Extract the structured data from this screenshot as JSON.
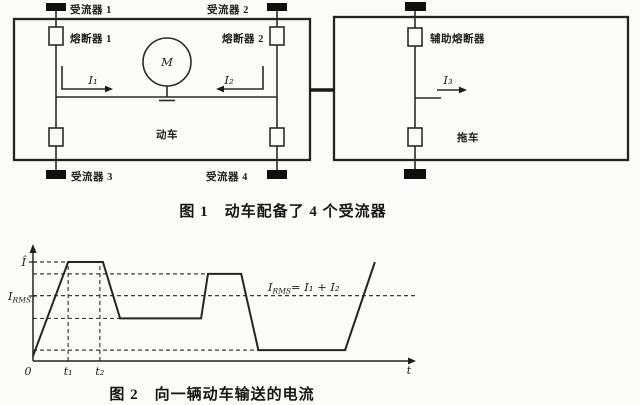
{
  "figure1": {
    "caption_no": "图 1",
    "caption_text": "动车配备了 4 个受流器",
    "labels": {
      "collector1": "受流器 1",
      "collector2": "受流器 2",
      "collector3": "受流器 3",
      "collector4": "受流器 4",
      "fuse1": "熔断器 1",
      "fuse2": "熔断器 2",
      "aux_fuse": "辅助熔断器",
      "motor": "M",
      "motor_car": "动车",
      "trailer": "拖车",
      "i1": "I₁",
      "i2": "I₂",
      "i3": "I₃"
    }
  },
  "figure2": {
    "caption_no": "图 2",
    "caption_text": "向一辆动车输送的电流",
    "peak_label": "Î",
    "rms_label_i": "I",
    "rms_label_sub": "RMS",
    "annotation_i": "I",
    "annotation_sub": "RMS",
    "annotation_rest": "= I₁ + I₂",
    "x_origin": "0",
    "x_end_label": "t"
  },
  "chart_data": {
    "type": "line",
    "title": "图 2 向一辆动车输送的电流",
    "xlabel": "t (time)",
    "ylabel": "I (current)",
    "x_tick_labels": [
      "0",
      "t₁",
      "t₂"
    ],
    "y_tick_labels": [
      "Î",
      "I_RMS"
    ],
    "annotation": "I_RMS = I₁ + I₂",
    "axis": {
      "x_range": [
        0,
        1
      ],
      "y_range": [
        0,
        1.1
      ],
      "grid": "dashed"
    },
    "levels": {
      "peak": 1.0,
      "second_peak": 0.88,
      "rms": 0.66,
      "mid": 0.43,
      "low": 0.11
    },
    "points": [
      [
        0.0,
        0.05
      ],
      [
        0.092,
        1.0
      ],
      [
        0.183,
        1.0
      ],
      [
        0.228,
        0.43
      ],
      [
        0.44,
        0.43
      ],
      [
        0.458,
        0.88
      ],
      [
        0.545,
        0.88
      ],
      [
        0.59,
        0.11
      ],
      [
        0.817,
        0.11
      ],
      [
        0.895,
        1.0
      ]
    ],
    "h_gridlines": [
      {
        "y": 1.0,
        "x_end": 0.183
      },
      {
        "y": 0.88,
        "x_end": 0.545
      },
      {
        "y": 0.66,
        "x_end": 1.0
      },
      {
        "y": 0.43,
        "x_end": 0.44
      },
      {
        "y": 0.11,
        "x_end": 0.59
      }
    ],
    "v_gridlines": [
      {
        "x": 0.092,
        "label": "t₁"
      },
      {
        "x": 0.175,
        "label": "t₂"
      }
    ]
  }
}
